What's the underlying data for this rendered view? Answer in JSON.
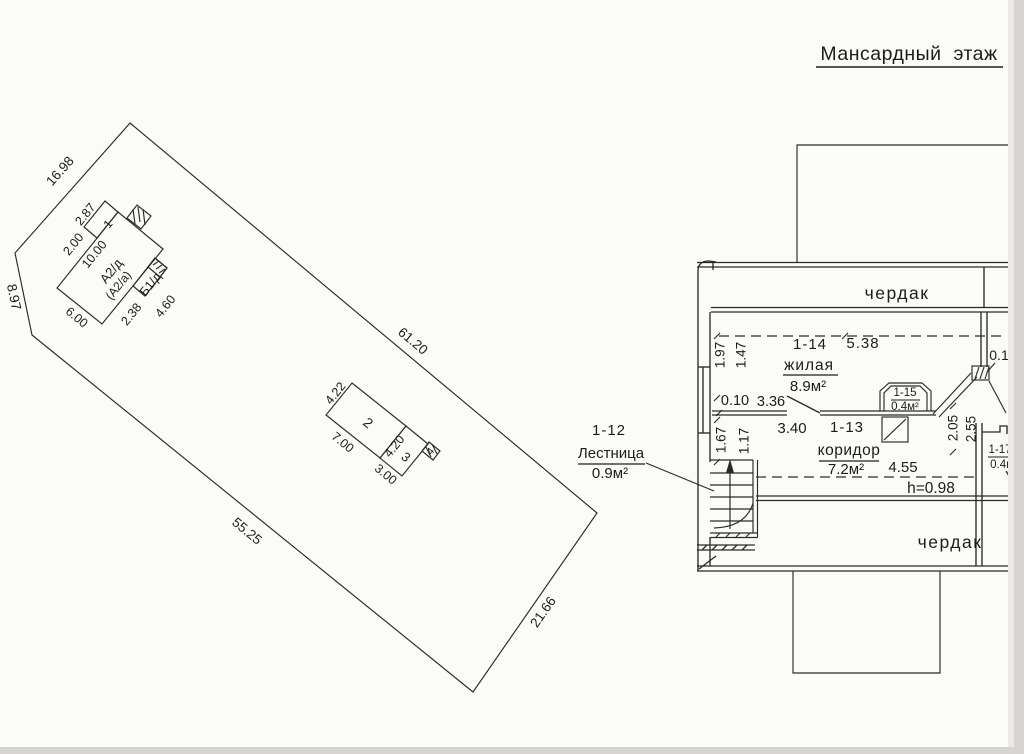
{
  "plan": {
    "title": "Мансардный этаж",
    "attic_top": "чердак",
    "attic_bottom": "чердак",
    "living_num": "1-14",
    "living_name": "жилая",
    "living_area": "8.9м²",
    "corridor_num": "1-13",
    "corridor_name": "коридор",
    "corridor_area": "7.2м²",
    "stairs_num": "1-12",
    "stairs_name": "Лестница",
    "stairs_area": "0.9м²",
    "closet15_num": "1-15",
    "closet15_area": "0.4м²",
    "closet17_num": "1-17",
    "closet17_area": "0.4м²",
    "dim_538": "5.38",
    "dim_197": "1.97",
    "dim_147": "1.47",
    "dim_010": "0.10",
    "dim_336": "3.36",
    "dim_340": "3.40",
    "dim_455": "4.55",
    "dim_h": "h=0.98",
    "dim_205": "2.05",
    "dim_255": "2.55",
    "dim_167": "1.67",
    "dim_117": "1.17",
    "dim_01": "0.1"
  },
  "site": {
    "dim_1698": "16.98",
    "dim_897": "8.97",
    "dim_6120": "61.20",
    "dim_2166": "21.66",
    "dim_5525": "55.25",
    "house_name": "А2/д",
    "house_name2": "(А2/а)",
    "house_annex": "Б1/д",
    "house_part": "1",
    "dim_287": "2.87",
    "dim_200": "2.00",
    "dim_1000": "10.00",
    "dim_600": "6.00",
    "dim_238": "2.38",
    "dim_460": "4.60",
    "barn_num": "2",
    "barn_annex": "3",
    "barn_shed": "4",
    "dim_422": "4.22",
    "dim_700": "7.00",
    "dim_420": "4.20",
    "dim_300": "3.00"
  }
}
